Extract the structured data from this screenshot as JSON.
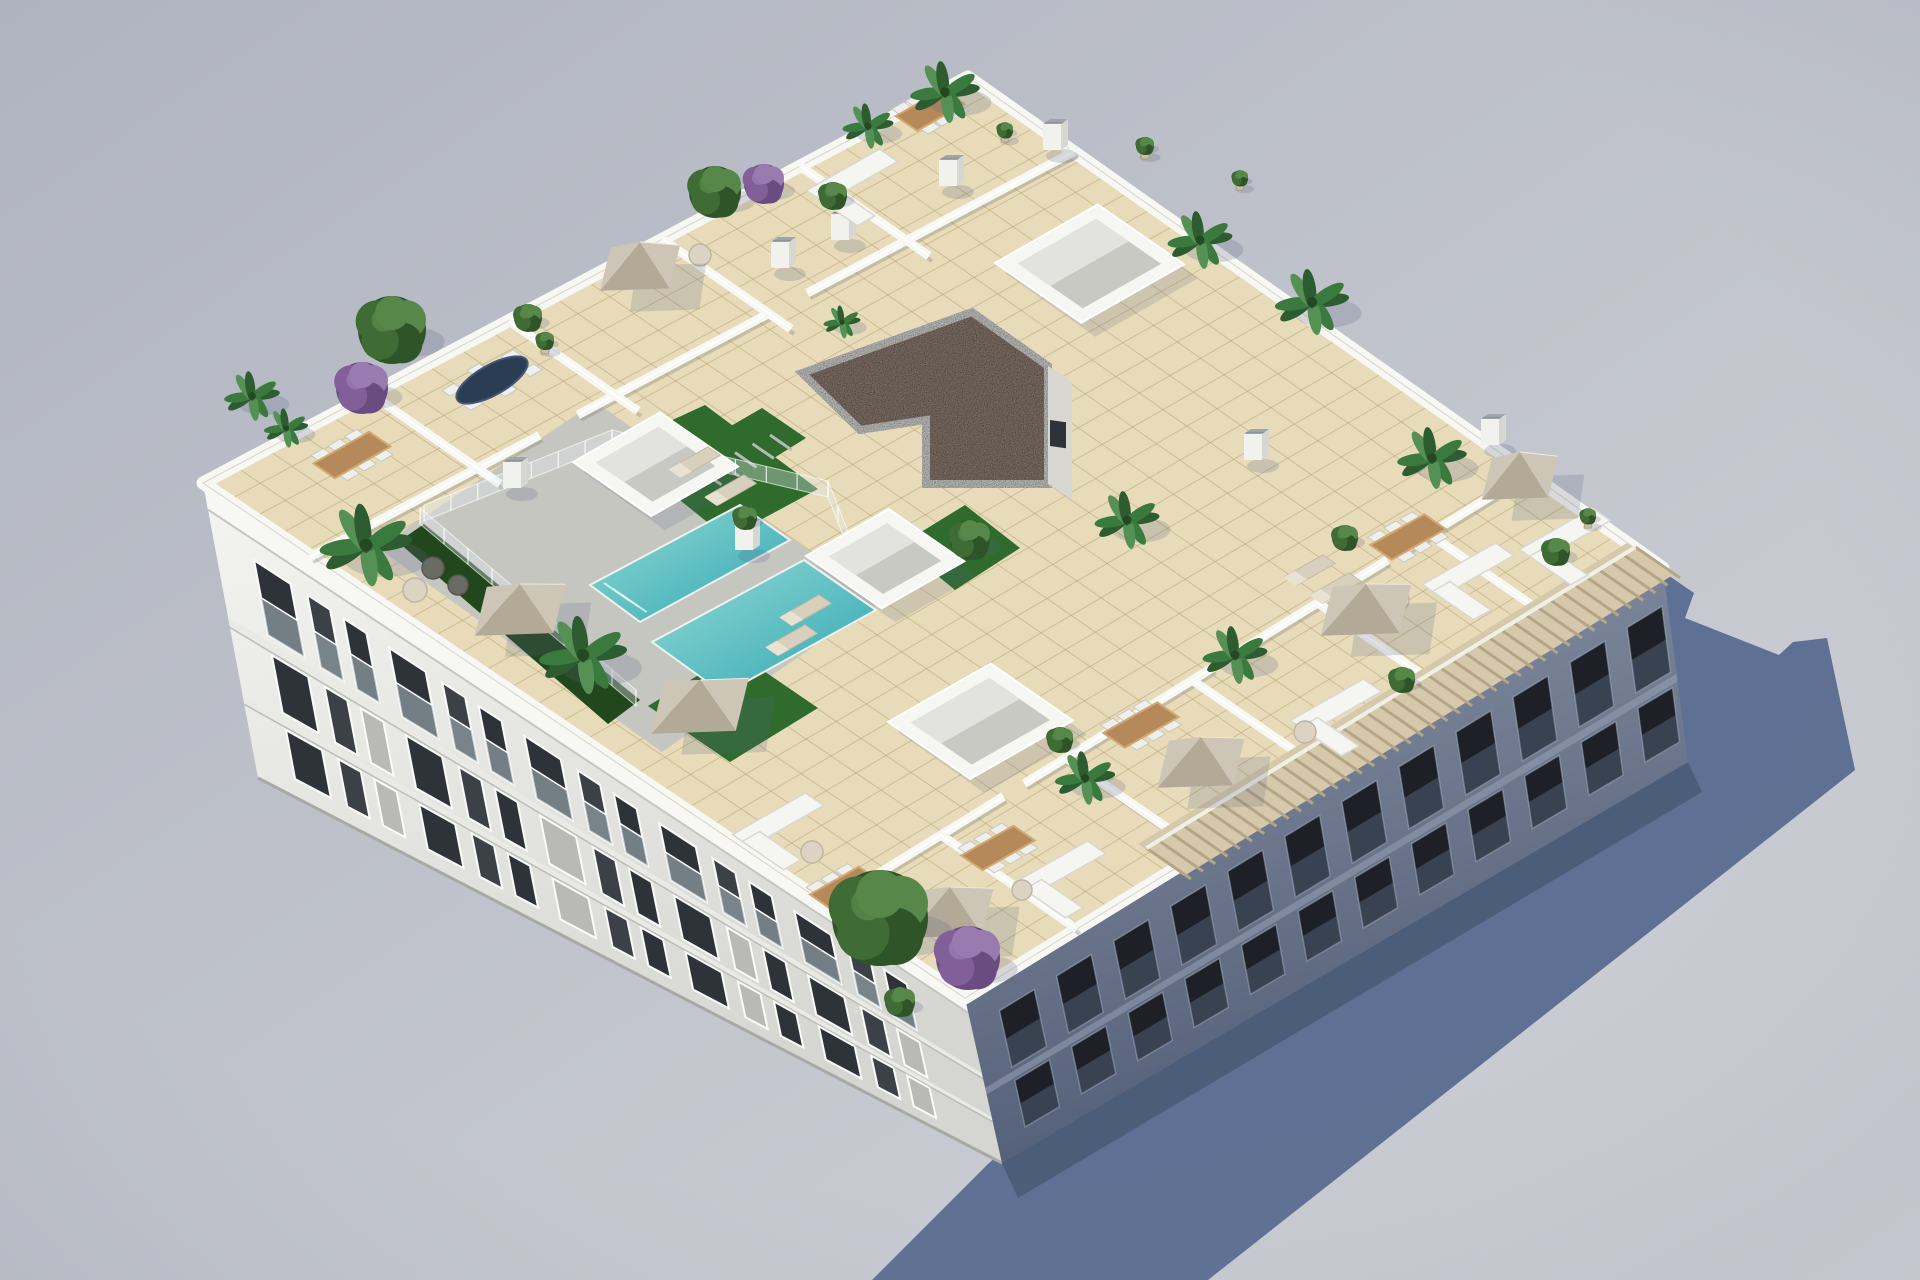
{
  "scene": {
    "width": 1920,
    "height": 1280,
    "colors": {
      "bg_top": "#b0b4bf",
      "bg_mid": "#c2c5cd",
      "bg_bot": "#d0d2d8",
      "shadow": "#5e7093",
      "shadow_dark": "#4c5d79",
      "tile": "#e7dbb9",
      "tile_line": "rgba(176,153,105,0.45)",
      "paving": "#c6c6c1",
      "turf": "#2e6b2c",
      "hedge": "#23471d",
      "pool_light": "#96dad6",
      "pool_dark": "#2fa7b2",
      "wall_white": "#f7f7f4",
      "wall_shade": "#d9d9d4",
      "facade_left_top": "#f4f4f1",
      "facade_left_bot": "#d5d5d1",
      "facade_right_top": "#8a94a7",
      "facade_right_bot": "#525e76",
      "window_dark": "#2e333a",
      "window_right": "#1d2127",
      "gravel": "#a08f83",
      "gravel_rim": "#f2f2ef",
      "pergola_band": "#d6c9ab",
      "pergola_slat": "#b3a585",
      "umbrella_l": "#e0d9cc",
      "umbrella_m": "#cdc5b5",
      "umbrella_d": "#b2a997",
      "wood": "#b6895a",
      "wood_hi": "#d2a873",
      "sofa": "#f5f5f1",
      "chair": "#eef0ee",
      "palm_dark": "#2d5c31",
      "palm_mid": "#3a7a3f",
      "palm_light": "#559154",
      "bush_dark": "#2f5428",
      "bush_mid": "#3f6b35",
      "bush_light": "#57884a",
      "purple_dark": "#6b4c80",
      "purple_mid": "#835f9a",
      "purple_light": "#9a7bb0",
      "skylight_face": "#f6f6f3",
      "skylight_in": "#c9c9c4",
      "navy_table": "#2b3d52"
    },
    "axes": {
      "uA": [
        0.87,
        -0.495
      ],
      "uB": [
        0.822,
        0.569
      ]
    },
    "roof": {
      "N": [
        968,
        77
      ],
      "W": [
        203,
        483
      ],
      "S": [
        965,
        998
      ],
      "E": [
        1663,
        568
      ]
    },
    "facade_bases": {
      "W": [
        258,
        778
      ],
      "S": [
        1002,
        1163
      ],
      "E": [
        1688,
        762
      ]
    },
    "shadow_poly": [
      [
        988,
        1164
      ],
      [
        1662,
        571
      ],
      [
        1694,
        593
      ],
      [
        1685,
        618
      ],
      [
        1779,
        655
      ],
      [
        1793,
        642
      ],
      [
        1827,
        638
      ],
      [
        1855,
        770
      ],
      [
        1208,
        1280
      ],
      [
        872,
        1280
      ]
    ],
    "shadow_strip": [
      [
        1002,
        1163
      ],
      [
        1688,
        762
      ],
      [
        1702,
        792
      ],
      [
        1018,
        1198
      ]
    ],
    "gravel_poly": [
      [
        802,
        373
      ],
      [
        972,
        312
      ],
      [
        1048,
        366
      ],
      [
        1048,
        484
      ],
      [
        926,
        484
      ],
      [
        926,
        420
      ],
      [
        860,
        430
      ]
    ],
    "gravel_face": [
      [
        1048,
        366
      ],
      [
        1048,
        484
      ],
      [
        1072,
        500
      ],
      [
        1072,
        382
      ]
    ],
    "gravel_window": [
      1050,
      420,
      16,
      26
    ],
    "skylights": [
      {
        "o": [
          573,
          462
        ],
        "la": 100,
        "lb": 95
      },
      {
        "o": [
          806,
          556
        ],
        "la": 95,
        "lb": 92
      },
      {
        "o": [
          995,
          263
        ],
        "la": 118,
        "lb": 105
      },
      {
        "o": [
          888,
          722
        ],
        "la": 118,
        "lb": 100
      }
    ],
    "pool": {
      "paving": [
        [
          378,
          548
        ],
        [
          595,
          402
        ],
        [
          880,
          600
        ],
        [
          662,
          752
        ]
      ],
      "quads": [
        [
          [
            590,
            585
          ],
          [
            740,
            505
          ],
          [
            790,
            540
          ],
          [
            640,
            622
          ]
        ],
        [
          [
            652,
            642
          ],
          [
            804,
            560
          ],
          [
            876,
            610
          ],
          [
            724,
            694
          ]
        ]
      ],
      "turf": [
        [
          [
            614,
            447
          ],
          [
            705,
            405
          ],
          [
            818,
            489
          ],
          [
            727,
            538
          ]
        ],
        [
          [
            648,
            706
          ],
          [
            736,
            652
          ],
          [
            818,
            708
          ],
          [
            730,
            762
          ]
        ],
        [
          [
            900,
            545
          ],
          [
            965,
            505
          ],
          [
            1020,
            548
          ],
          [
            955,
            590
          ]
        ]
      ],
      "hedge": [
        [
          398,
          542
        ],
        [
          424,
          524
        ],
        [
          640,
          700
        ],
        [
          608,
          724
        ]
      ],
      "steps": [
        [
          604,
          583
        ],
        [
          613,
          589
        ],
        [
          622,
          595
        ]
      ],
      "stairs": {
        "p1": [
          700,
          470
        ],
        "p2": [
          770,
          435
        ],
        "n": 5
      },
      "stair_turf": [
        [
          698,
          445
        ],
        [
          762,
          408
        ],
        [
          806,
          438
        ],
        [
          742,
          478
        ]
      ]
    },
    "fences": [
      [
        [
          612,
          446
        ],
        [
          828,
          497
        ]
      ],
      [
        [
          424,
          521
        ],
        [
          612,
          446
        ]
      ],
      [
        [
          828,
          497
        ],
        [
          868,
          598
        ]
      ],
      [
        [
          420,
          524
        ],
        [
          636,
          706
        ]
      ]
    ],
    "walls_nw": {
      "inner": {
        "p1": [
          310,
          557
        ],
        "p2": [
          1075,
          151
        ],
        "segs": [
          [
            0,
            0.3
          ],
          [
            0.35,
            0.6
          ],
          [
            0.65,
            1.0
          ]
        ]
      },
      "cross": [
        [
          [
            371,
            394
          ],
          [
            500,
            484
          ]
        ],
        [
          [
            509,
            321
          ],
          [
            638,
            411
          ]
        ],
        [
          [
            662,
            239
          ],
          [
            791,
            329
          ]
        ],
        [
          [
            800,
            166
          ],
          [
            929,
            256
          ]
        ]
      ]
    },
    "walls_se": {
      "inner": {
        "p1": [
          829,
          904
        ],
        "p2": [
          1527,
          474
        ],
        "segs": [
          [
            0,
            0.25
          ],
          [
            0.28,
            0.55
          ],
          [
            0.58,
            0.8
          ],
          [
            0.83,
            1.0
          ]
        ]
      },
      "cross": [
        [
          [
            1077,
            929
          ],
          [
            941,
            835
          ]
        ],
        [
          [
            1202,
            852
          ],
          [
            1066,
            758
          ]
        ],
        [
          [
            1328,
            774
          ],
          [
            1192,
            680
          ]
        ],
        [
          [
            1454,
            697
          ],
          [
            1318,
            603
          ]
        ],
        [
          [
            1565,
            628
          ],
          [
            1429,
            534
          ]
        ]
      ]
    },
    "pergola": {
      "band": [
        [
          1184,
          876
        ],
        [
          1673,
          575
        ],
        [
          1627,
          543
        ],
        [
          1138,
          844
        ]
      ],
      "start": [
        1181,
        872
      ],
      "end": [
        1670,
        571
      ],
      "slats": 40
    },
    "chimneys": [
      [
        780,
        268
      ],
      [
        948,
        186
      ],
      [
        1052,
        150
      ],
      [
        512,
        488
      ],
      [
        744,
        550
      ],
      [
        1253,
        460
      ],
      [
        1490,
        445
      ],
      [
        840,
        240
      ]
    ],
    "umbrellas": [
      {
        "c": [
          640,
          268
        ],
        "r": 46
      },
      {
        "c": [
          520,
          610
        ],
        "r": 52
      },
      {
        "c": [
          700,
          706
        ],
        "r": 56
      },
      {
        "c": [
          950,
          913
        ],
        "r": 50
      },
      {
        "c": [
          1201,
          763
        ],
        "r": 50
      },
      {
        "c": [
          1366,
          610
        ],
        "r": 52
      },
      {
        "c": [
          1520,
          478
        ],
        "r": 44
      }
    ],
    "tables_wood": [
      {
        "c": [
          352,
          455
        ],
        "L": 64
      },
      {
        "c": [
          930,
          110
        ],
        "L": 54
      },
      {
        "c": [
          1408,
          537
        ],
        "L": 62
      },
      {
        "c": [
          1141,
          725
        ],
        "L": 62
      },
      {
        "c": [
          998,
          848
        ],
        "L": 60
      },
      {
        "c": [
          845,
          888
        ],
        "L": 56
      },
      {
        "c": [
          560,
          680
        ],
        "L": 0
      }
    ],
    "navy_table": {
      "c": [
        492,
        380
      ],
      "rx": 40,
      "ry": 15
    },
    "sofas": [
      [
        852,
        176
      ],
      [
        1468,
        570
      ],
      [
        1336,
        706
      ],
      [
        1060,
        868
      ],
      [
        778,
        820
      ],
      [
        1565,
        535
      ]
    ],
    "round_tables": [
      [
        700,
        255,
        11
      ],
      [
        1398,
        600,
        11
      ],
      [
        1305,
        732,
        11
      ],
      [
        812,
        852,
        11
      ],
      [
        1022,
        890,
        10
      ],
      [
        415,
        590,
        12
      ]
    ],
    "loungers": [
      [
        695,
        462
      ],
      [
        731,
        490
      ],
      [
        806,
        610
      ],
      [
        792,
        640
      ],
      [
        1310,
        570
      ],
      [
        1336,
        588
      ]
    ],
    "wicker_seats": [
      [
        433,
        568,
        11
      ],
      [
        458,
        585,
        10
      ]
    ],
    "plants": {
      "palms": [
        [
          252,
          396,
          24
        ],
        [
          286,
          428,
          19
        ],
        [
          366,
          545,
          40
        ],
        [
          583,
          655,
          38
        ],
        [
          945,
          92,
          30
        ],
        [
          868,
          126,
          22
        ],
        [
          1200,
          240,
          28
        ],
        [
          1312,
          302,
          32
        ],
        [
          1432,
          458,
          30
        ],
        [
          1127,
          520,
          28
        ],
        [
          842,
          322,
          16
        ],
        [
          1085,
          778,
          26
        ],
        [
          1235,
          655,
          28
        ]
      ],
      "bushes": [
        [
          392,
          330,
          34
        ],
        [
          715,
          192,
          26
        ],
        [
          833,
          196,
          14
        ],
        [
          880,
          918,
          48
        ],
        [
          1060,
          740,
          13
        ],
        [
          1345,
          538,
          13
        ],
        [
          1402,
          680,
          13
        ],
        [
          1556,
          552,
          14
        ],
        [
          970,
          540,
          20
        ],
        [
          900,
          1002,
          15
        ],
        [
          745,
          518,
          12
        ],
        [
          528,
          318,
          14
        ]
      ],
      "purples": [
        [
          362,
          388,
          26
        ],
        [
          764,
          184,
          20
        ],
        [
          968,
          958,
          32
        ]
      ],
      "pots": [
        [
          1145,
          150,
          10
        ],
        [
          1240,
          182,
          9
        ],
        [
          1005,
          134,
          9
        ],
        [
          545,
          345,
          10
        ],
        [
          1588,
          520,
          9
        ]
      ]
    },
    "facade_left": {
      "rows": [
        {
          "t0": 0.17,
          "t1": 0.43,
          "balcony": true
        },
        {
          "t0": 0.5,
          "t1": 0.7,
          "balcony": false
        },
        {
          "t0": 0.76,
          "t1": 0.93,
          "balcony": false
        }
      ],
      "bands": [
        [
          0.455,
          0.49
        ],
        [
          0.72,
          0.75
        ]
      ],
      "parapet_t": 0.09
    },
    "facade_right": {
      "rows": [
        {
          "t0": 0.18,
          "t1": 0.52
        },
        {
          "t0": 0.6,
          "t1": 0.88
        }
      ],
      "band": [
        0.545,
        0.585
      ]
    },
    "tile_grid": {
      "na": 24,
      "nb": 30
    }
  }
}
